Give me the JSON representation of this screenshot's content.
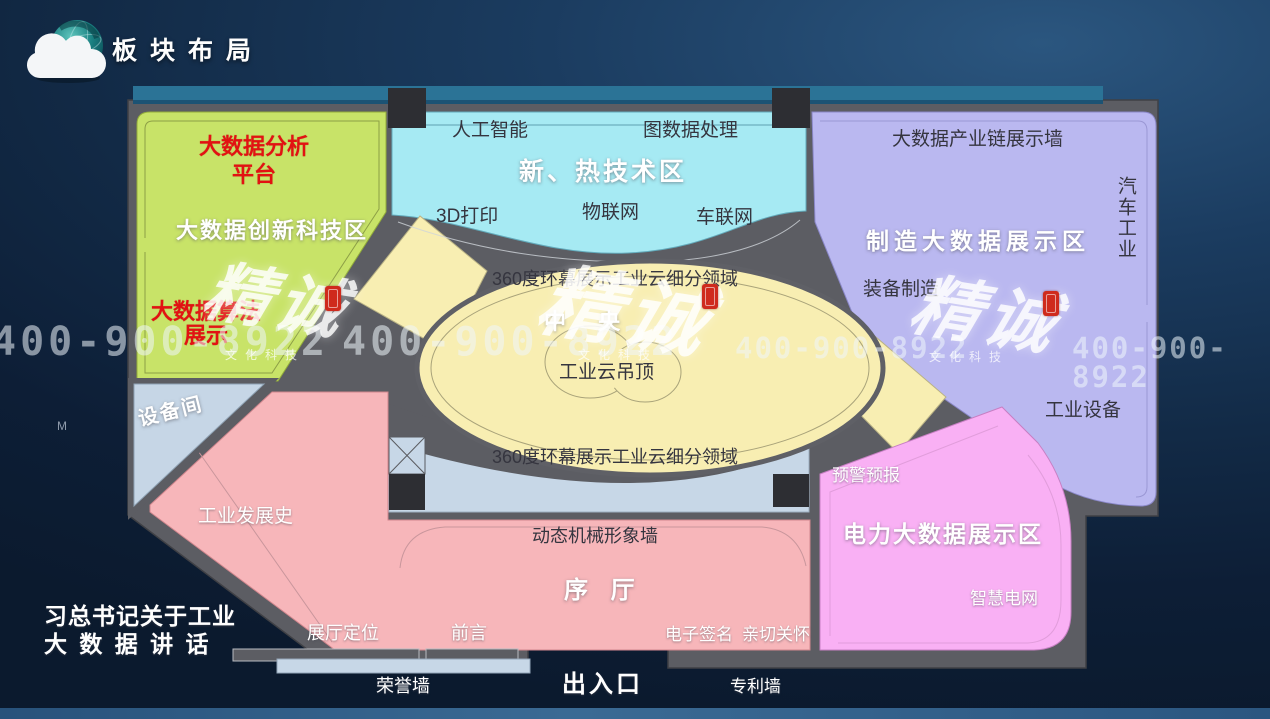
{
  "header": {
    "title": "板块布局"
  },
  "side": {
    "m_label": "M",
    "speech_line1": "习总书记关于工业",
    "speech_line2": "大 数 据 讲 话"
  },
  "zones": {
    "green": {
      "title": "大数据创新科技区",
      "platform": "大数据分析\n平台",
      "algorithm": "大数据算法\n展示"
    },
    "cyan": {
      "title": "新、热技术区",
      "ai": "人工智能",
      "graph": "图数据处理",
      "print3d": "3D打印",
      "iot": "物联网",
      "iov": "车联网"
    },
    "purple": {
      "title": "制造大数据展示区",
      "chain_wall": "大数据产业链展示墙",
      "auto_industry": "汽车工业",
      "equipment_mfg": "装备制造",
      "industrial_equipment": "工业设备"
    },
    "center": {
      "title": "中 央",
      "screen_top": "360度环幕展示工业云细分领域",
      "screen_bottom": "360度环幕展示工业云细分领域",
      "cloud_ceiling": "工业云吊顶"
    },
    "pink": {
      "title": "序 厅",
      "history_wall": "工业发展史",
      "mech_wall": "动态机械形象墙",
      "positioning": "展厅定位",
      "preface": "前言",
      "esignature": "电子签名",
      "care": "亲切关怀"
    },
    "magenta": {
      "title": "电力大数据展示区",
      "warning": "预警预报",
      "smart_grid": "智慧电网"
    },
    "service": {
      "equipment_room": "设备间"
    }
  },
  "bottom": {
    "honor_wall": "荣誉墙",
    "entrance": "出入口",
    "patent_wall": "专利墙"
  },
  "watermark": {
    "phone": "400-900-8922",
    "brand": "精诚",
    "brand_sub": "文化科技"
  },
  "colors": {
    "green_zone": "#c8e368",
    "cyan_zone": "#a6eaf3",
    "purple_zone": "#bab8f0",
    "yellow_zone": "#f8eeb2",
    "pink_zone": "#f7b6ba",
    "magenta_zone": "#f9b0f4",
    "wall_gray": "#5c5d63",
    "light_blue": "#c7d7e7",
    "teal_strip": "#2b7396",
    "accent_red": "#e21212"
  }
}
